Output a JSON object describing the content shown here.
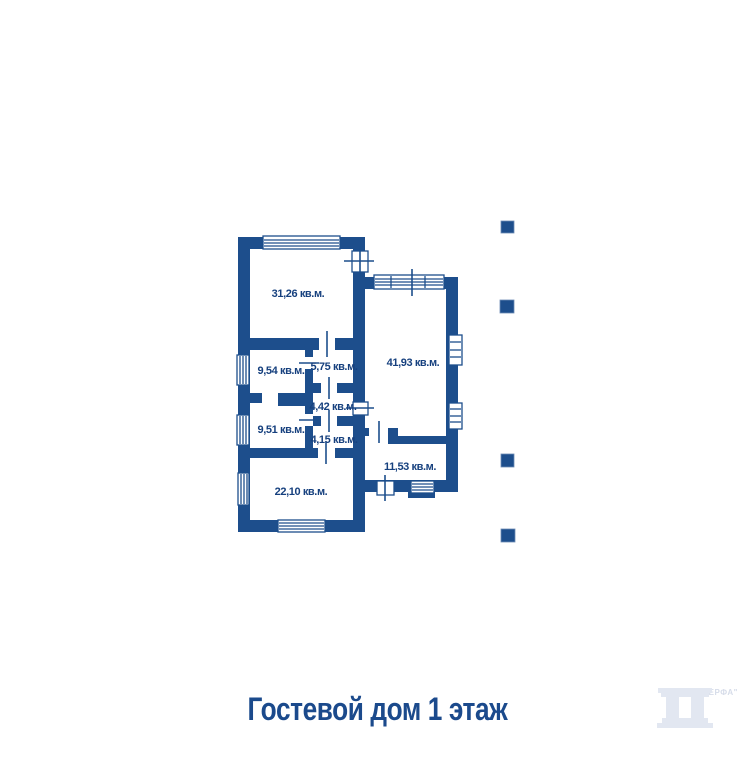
{
  "title": {
    "text": "Гостевой дом 1 этаж"
  },
  "colors": {
    "background": "#ffffff",
    "wall": "#1d4e8c",
    "room_label": "#16407e",
    "title": "#1b4a8c",
    "watermark": "#e2e7f1",
    "watermark_text": "#d6dce9"
  },
  "plan": {
    "unit": "кв.м.",
    "rooms": [
      {
        "id": "living-room",
        "label": "31,26 кв.м."
      },
      {
        "id": "hall-right",
        "label": "41,93 кв.м."
      },
      {
        "id": "room-9-54",
        "label": "9,54 кв.м."
      },
      {
        "id": "room-5-75",
        "label": "5,75 кв.м."
      },
      {
        "id": "room-4-42",
        "label": "4,42 кв.м."
      },
      {
        "id": "room-9-51",
        "label": "9,51 кв.м."
      },
      {
        "id": "room-4-15",
        "label": "4,15 кв.м."
      },
      {
        "id": "room-22-10",
        "label": "22,10 кв.м."
      },
      {
        "id": "room-11-53",
        "label": "11,53 кв.м."
      }
    ]
  },
  "gallery_bullets": {
    "count": 4
  },
  "watermark": {
    "text": "Фирма \"ВЕРФА\""
  }
}
